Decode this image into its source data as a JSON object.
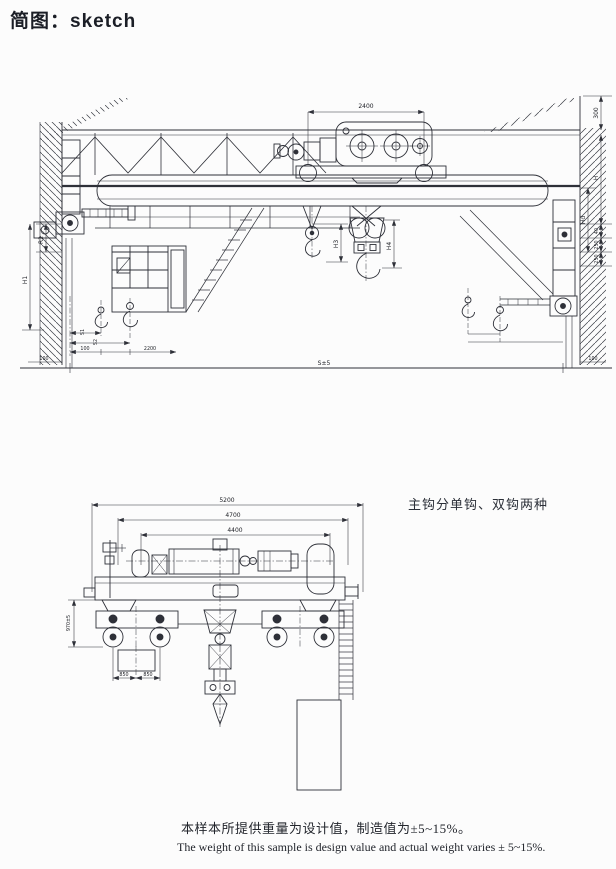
{
  "page": {
    "title": "简图：sketch",
    "hook_note": "主钩分单钩、双钩两种",
    "footer_cn": "本样本所提供重量为设计值，制造值为±5~15%。",
    "footer_en": "The  weight of this sample is design value and actual weight varies ± 5~15%."
  },
  "front_view": {
    "dims": {
      "trolley_width": "2400",
      "right_300": "300",
      "right_h": "H",
      "right_hd": "Hd",
      "right_40": "40",
      "right_250a": "250",
      "right_250b": "250",
      "left_r2": "R2",
      "left_h1": "H1",
      "aux_hook": "H3",
      "main_hook": "H4",
      "s1": "S1",
      "s2": "S2",
      "hook_offset": "100",
      "hook_gauge": "2200",
      "floor_left": "100",
      "floor_right": "100",
      "span": "S±5"
    }
  },
  "end_view": {
    "dims": {
      "overall": "5200",
      "outer": "4700",
      "inner": "4400",
      "height": "970±5",
      "bogie_a": "850",
      "bogie_b": "850"
    }
  }
}
